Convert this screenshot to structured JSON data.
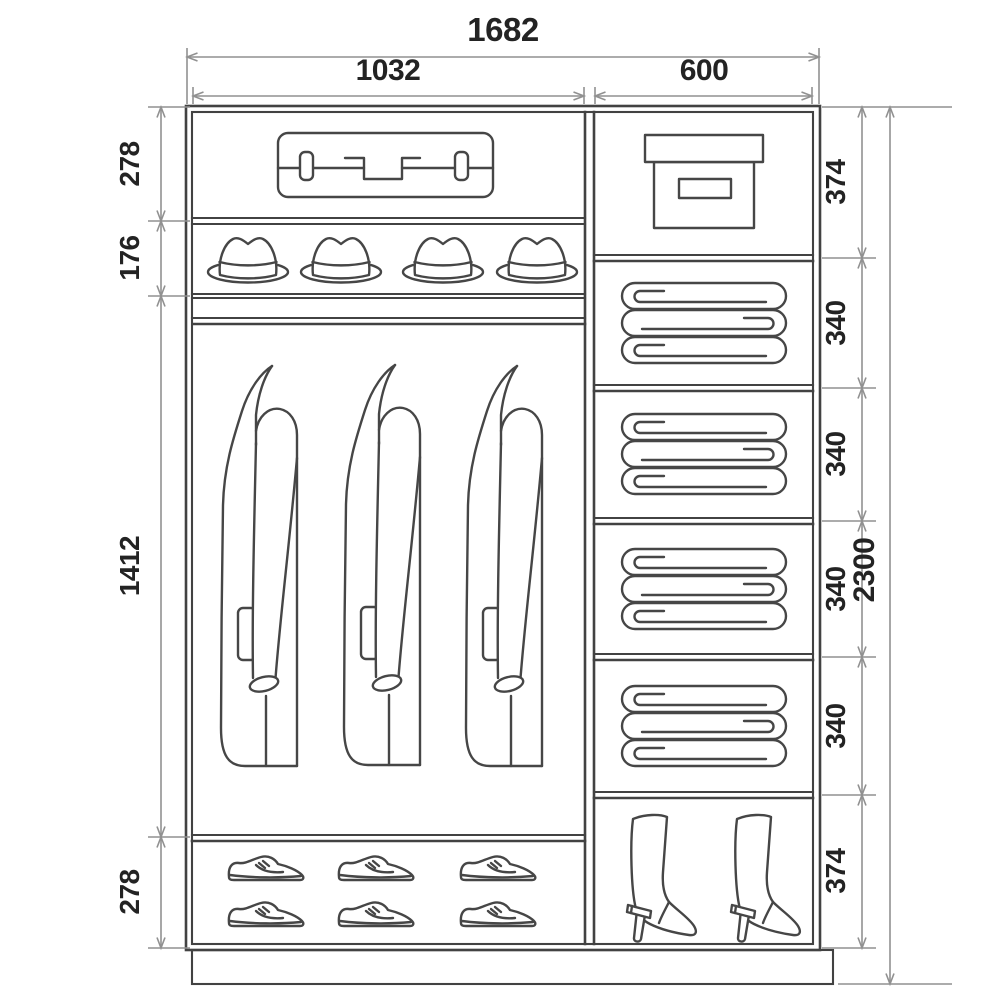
{
  "colors": {
    "background": "#ffffff",
    "structure_line": "#424242",
    "dimension_line": "#919191",
    "label_text": "#232323"
  },
  "dimensions": {
    "total_width": "1682",
    "left_section_width": "1032",
    "right_section_width": "600",
    "total_height": "2300",
    "left_heights": [
      "278",
      "176",
      "1412",
      "278"
    ],
    "right_heights": [
      "374",
      "340",
      "340",
      "340",
      "340",
      "374"
    ]
  },
  "wardrobe": {
    "left_column": {
      "icons": {
        "top_shelf": "suitcase-icon",
        "hat_shelf": "hat-icon",
        "hanging_section": "coat-icon",
        "bottom_shelf": "shoe-icon"
      },
      "counts": {
        "suitcases": 1,
        "hats": 4,
        "coats": 3,
        "shoes": 6
      }
    },
    "right_column": {
      "icons": {
        "top_shelf": "storage-box-icon",
        "middle_shelves": "folded-linen-icon",
        "bottom_shelf": "boot-icon"
      },
      "counts": {
        "boxes": 1,
        "linen_stacks": 4,
        "boots": 2
      }
    }
  }
}
